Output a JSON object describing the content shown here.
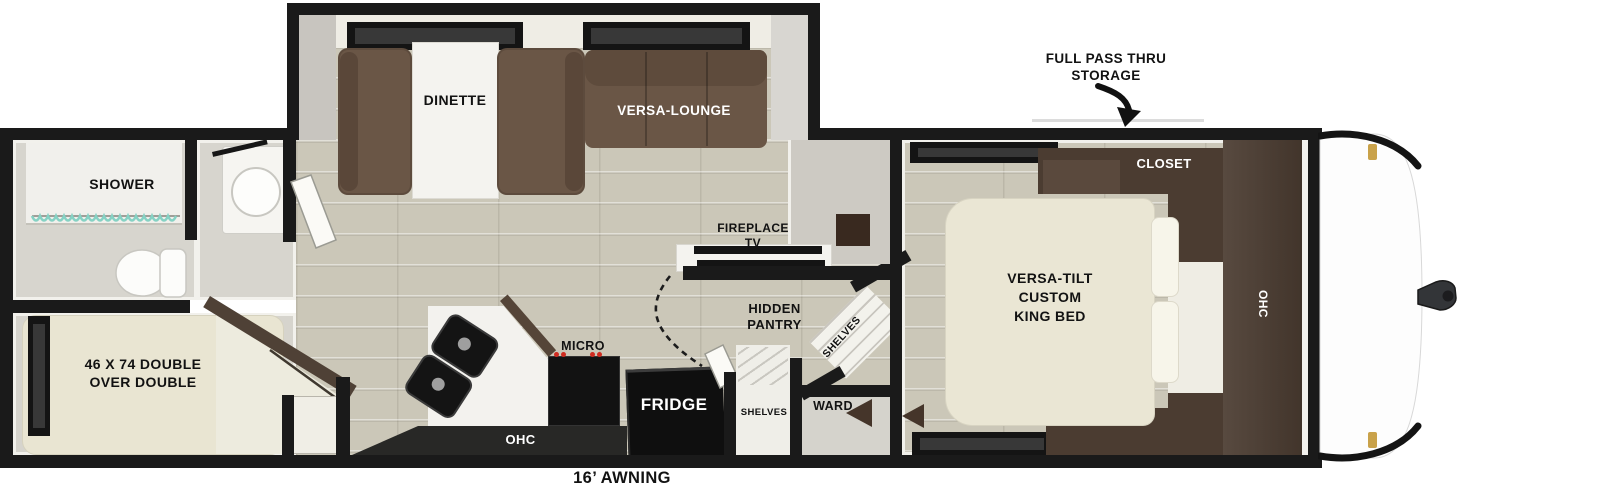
{
  "floorplan": {
    "awning_label": "16’ AWNING",
    "storage_callout": {
      "line1": "FULL PASS THRU",
      "line2": "STORAGE"
    },
    "rooms": {
      "shower": "SHOWER",
      "dinette": "DINETTE",
      "versa_lounge": "VERSA-LOUNGE",
      "bunk_line1": "46 X 74 DOUBLE",
      "bunk_line2": "OVER DOUBLE",
      "fireplace_line1": "FIREPLACE",
      "fireplace_line2": "TV",
      "hidden_pantry_line1": "HIDDEN",
      "hidden_pantry_line2": "PANTRY",
      "micro": "MICRO",
      "kitchen_ohc": "OHC",
      "fridge": "FRIDGE",
      "shelves_corner": "SHELVES",
      "shelves_closet": "SHELVES",
      "ward": "WARD",
      "closet": "CLOSET",
      "bedroom_ohc": "OHC",
      "bed_line1": "VERSA-TILT",
      "bed_line2": "CUSTOM",
      "bed_line3": "KING BED"
    },
    "colors": {
      "wall_black": "#1a1a1a",
      "floor_beige": "#cbc7b8",
      "sofa_brown": "#6a5646",
      "cabinet_brown": "#4b3c31",
      "mattress_cream": "#eae6d4",
      "bath_gray": "#d7d5ce",
      "counter_white": "#f3f2ee",
      "appliance_black": "#111111",
      "curtain_teal": "#86d2c4",
      "knob_red": "#cf2b20",
      "hitch_gray": "#2f2f31",
      "pin_gold": "#c9a24a"
    }
  }
}
